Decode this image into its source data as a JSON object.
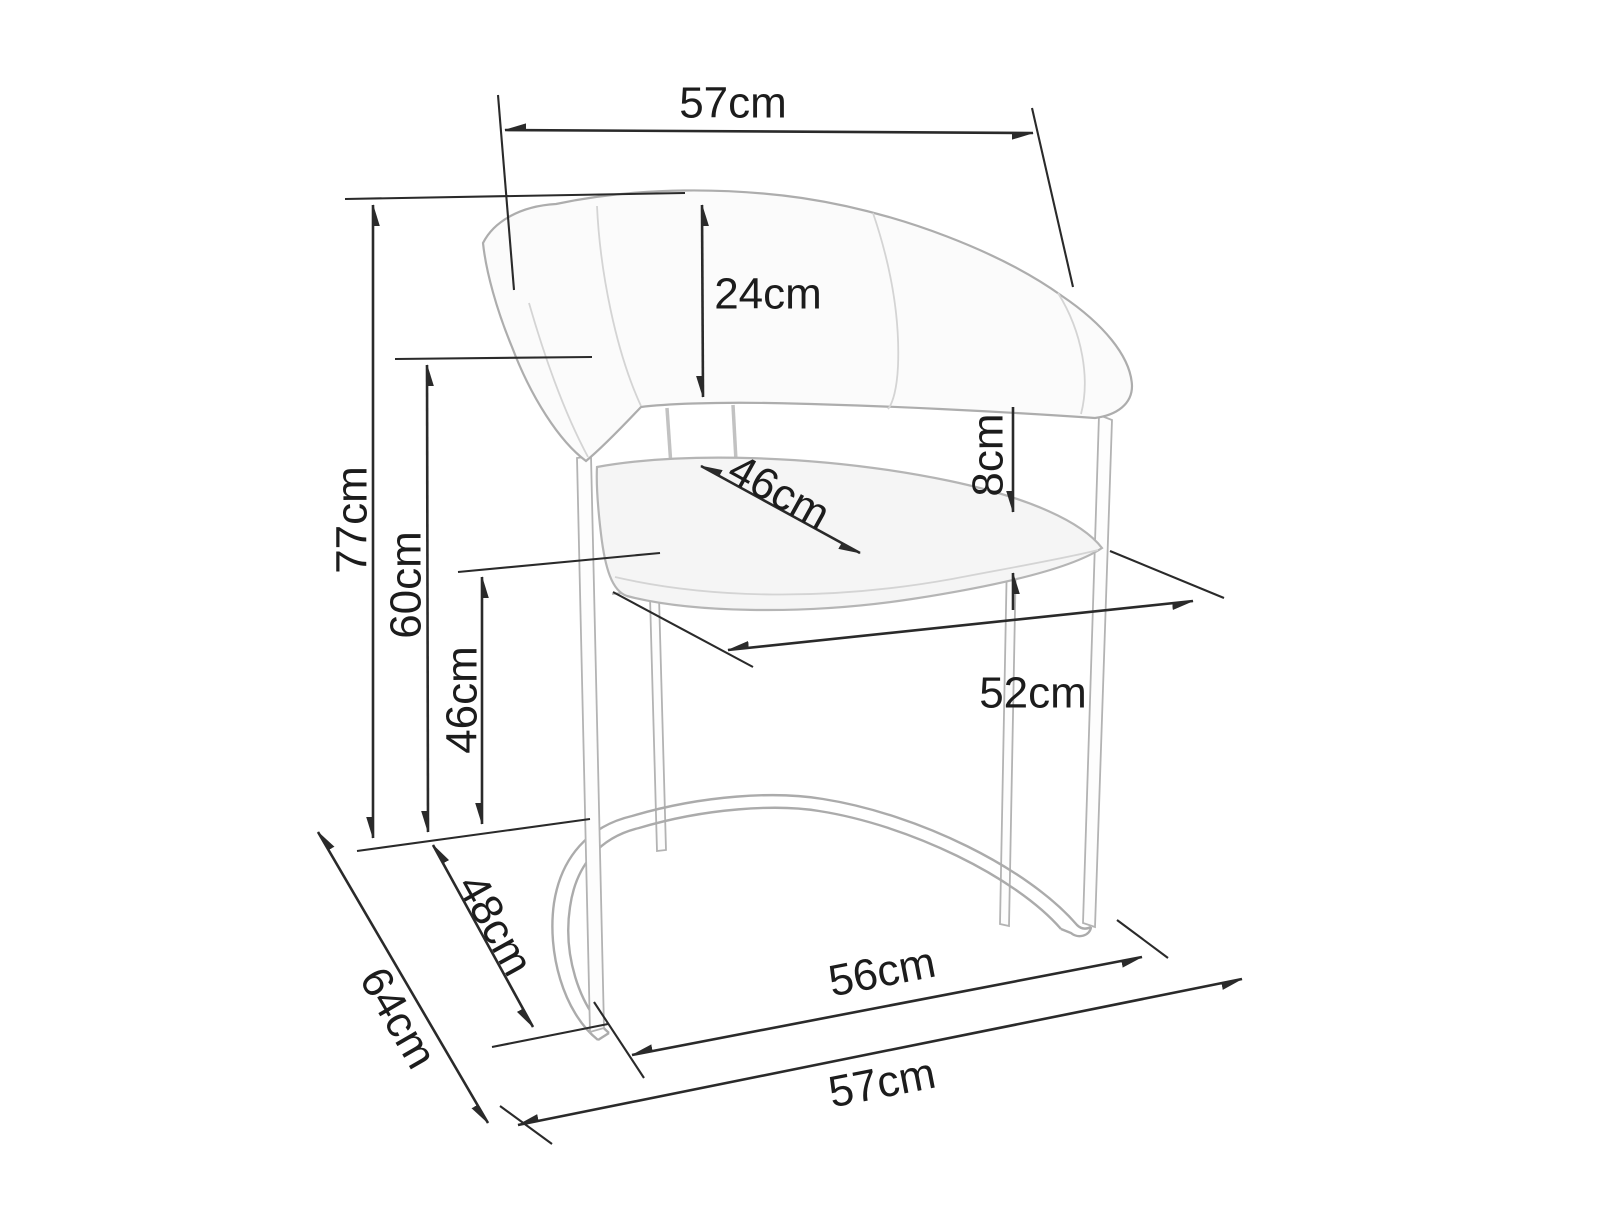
{
  "figure": {
    "type": "furniture-dimension-diagram",
    "subject": "curved-back cantilever armchair, technical line drawing with measurements",
    "units": "cm",
    "background_color": "#ffffff",
    "line_color": "#2a2a2a",
    "art_color": "#b3b3b3",
    "text_color": "#1c1c1c"
  },
  "measurements_cm": [
    57,
    24,
    77,
    60,
    46,
    8,
    46,
    52,
    56,
    57,
    48,
    64
  ],
  "dimensions": [
    {
      "id": "top-width",
      "label": "57cm",
      "value": 57,
      "line": [
        505,
        130,
        1033,
        133
      ],
      "ext": [
        [
          498,
          95,
          514,
          290
        ],
        [
          1032,
          108,
          1073,
          287
        ]
      ],
      "text": {
        "x": 733,
        "y": 103,
        "rot": 0
      }
    },
    {
      "id": "backrest-height",
      "label": "24cm",
      "value": 24,
      "line": [
        702,
        205,
        703,
        397
      ],
      "ext": [],
      "text": {
        "x": 768,
        "y": 294,
        "rot": 0
      }
    },
    {
      "id": "overall-height",
      "label": "77cm",
      "value": 77,
      "line": [
        373,
        205,
        373,
        838
      ],
      "ext": [
        [
          345,
          199,
          685,
          193
        ],
        [
          357,
          851,
          590,
          819
        ]
      ],
      "text": {
        "x": 352,
        "y": 520,
        "rot": -90
      }
    },
    {
      "id": "backrest-top-height",
      "label": "60cm",
      "value": 60,
      "line": [
        427,
        365,
        428,
        832
      ],
      "ext": [
        [
          395,
          359,
          592,
          357
        ]
      ],
      "text": {
        "x": 406,
        "y": 585,
        "rot": -90
      }
    },
    {
      "id": "seat-height",
      "label": "46cm",
      "value": 46,
      "line": [
        482,
        577,
        482,
        824
      ],
      "ext": [
        [
          458,
          572,
          660,
          553
        ]
      ],
      "text": {
        "x": 462,
        "y": 700,
        "rot": -90
      }
    },
    {
      "id": "seat-thickness",
      "label": "8cm",
      "value": 8,
      "segs": [
        [
          1013,
          407,
          1013,
          512
        ],
        [
          1013,
          610,
          1013,
          573
        ]
      ],
      "ext": [],
      "text": {
        "x": 988,
        "y": 455,
        "rot": -90
      }
    },
    {
      "id": "seat-depth",
      "label": "46cm",
      "value": 46,
      "line": [
        701,
        466,
        860,
        553
      ],
      "ext": [],
      "text": {
        "x": 779,
        "y": 492,
        "rot": 29
      }
    },
    {
      "id": "seat-width",
      "label": "52cm",
      "value": 52,
      "line": [
        728,
        650,
        1193,
        601
      ],
      "ext": [
        [
          613,
          592,
          753,
          667
        ],
        [
          1110,
          551,
          1224,
          598
        ]
      ],
      "text": {
        "x": 1033,
        "y": 693,
        "rot": 0
      }
    },
    {
      "id": "base-width",
      "label": "56cm",
      "value": 56,
      "line": [
        632,
        1055,
        1142,
        957
      ],
      "ext": [
        [
          594,
          1002,
          644,
          1078
        ],
        [
          1117,
          920,
          1168,
          958
        ]
      ],
      "text": {
        "x": 882,
        "y": 972,
        "rot": -11
      }
    },
    {
      "id": "bottom-width",
      "label": "57cm",
      "value": 57,
      "line": [
        518,
        1125,
        1242,
        979
      ],
      "ext": [
        [
          500,
          1106,
          552,
          1144
        ]
      ],
      "text": {
        "x": 882,
        "y": 1083,
        "rot": -11
      }
    },
    {
      "id": "base-depth",
      "label": "48cm",
      "value": 48,
      "line": [
        433,
        845,
        533,
        1027
      ],
      "ext": [
        [
          492,
          1047,
          608,
          1024
        ]
      ],
      "text": {
        "x": 495,
        "y": 925,
        "rot": 61
      }
    },
    {
      "id": "overall-depth",
      "label": "64cm",
      "value": 64,
      "line": [
        318,
        832,
        488,
        1123
      ],
      "ext": [],
      "text": {
        "x": 398,
        "y": 1018,
        "rot": 60
      }
    }
  ]
}
